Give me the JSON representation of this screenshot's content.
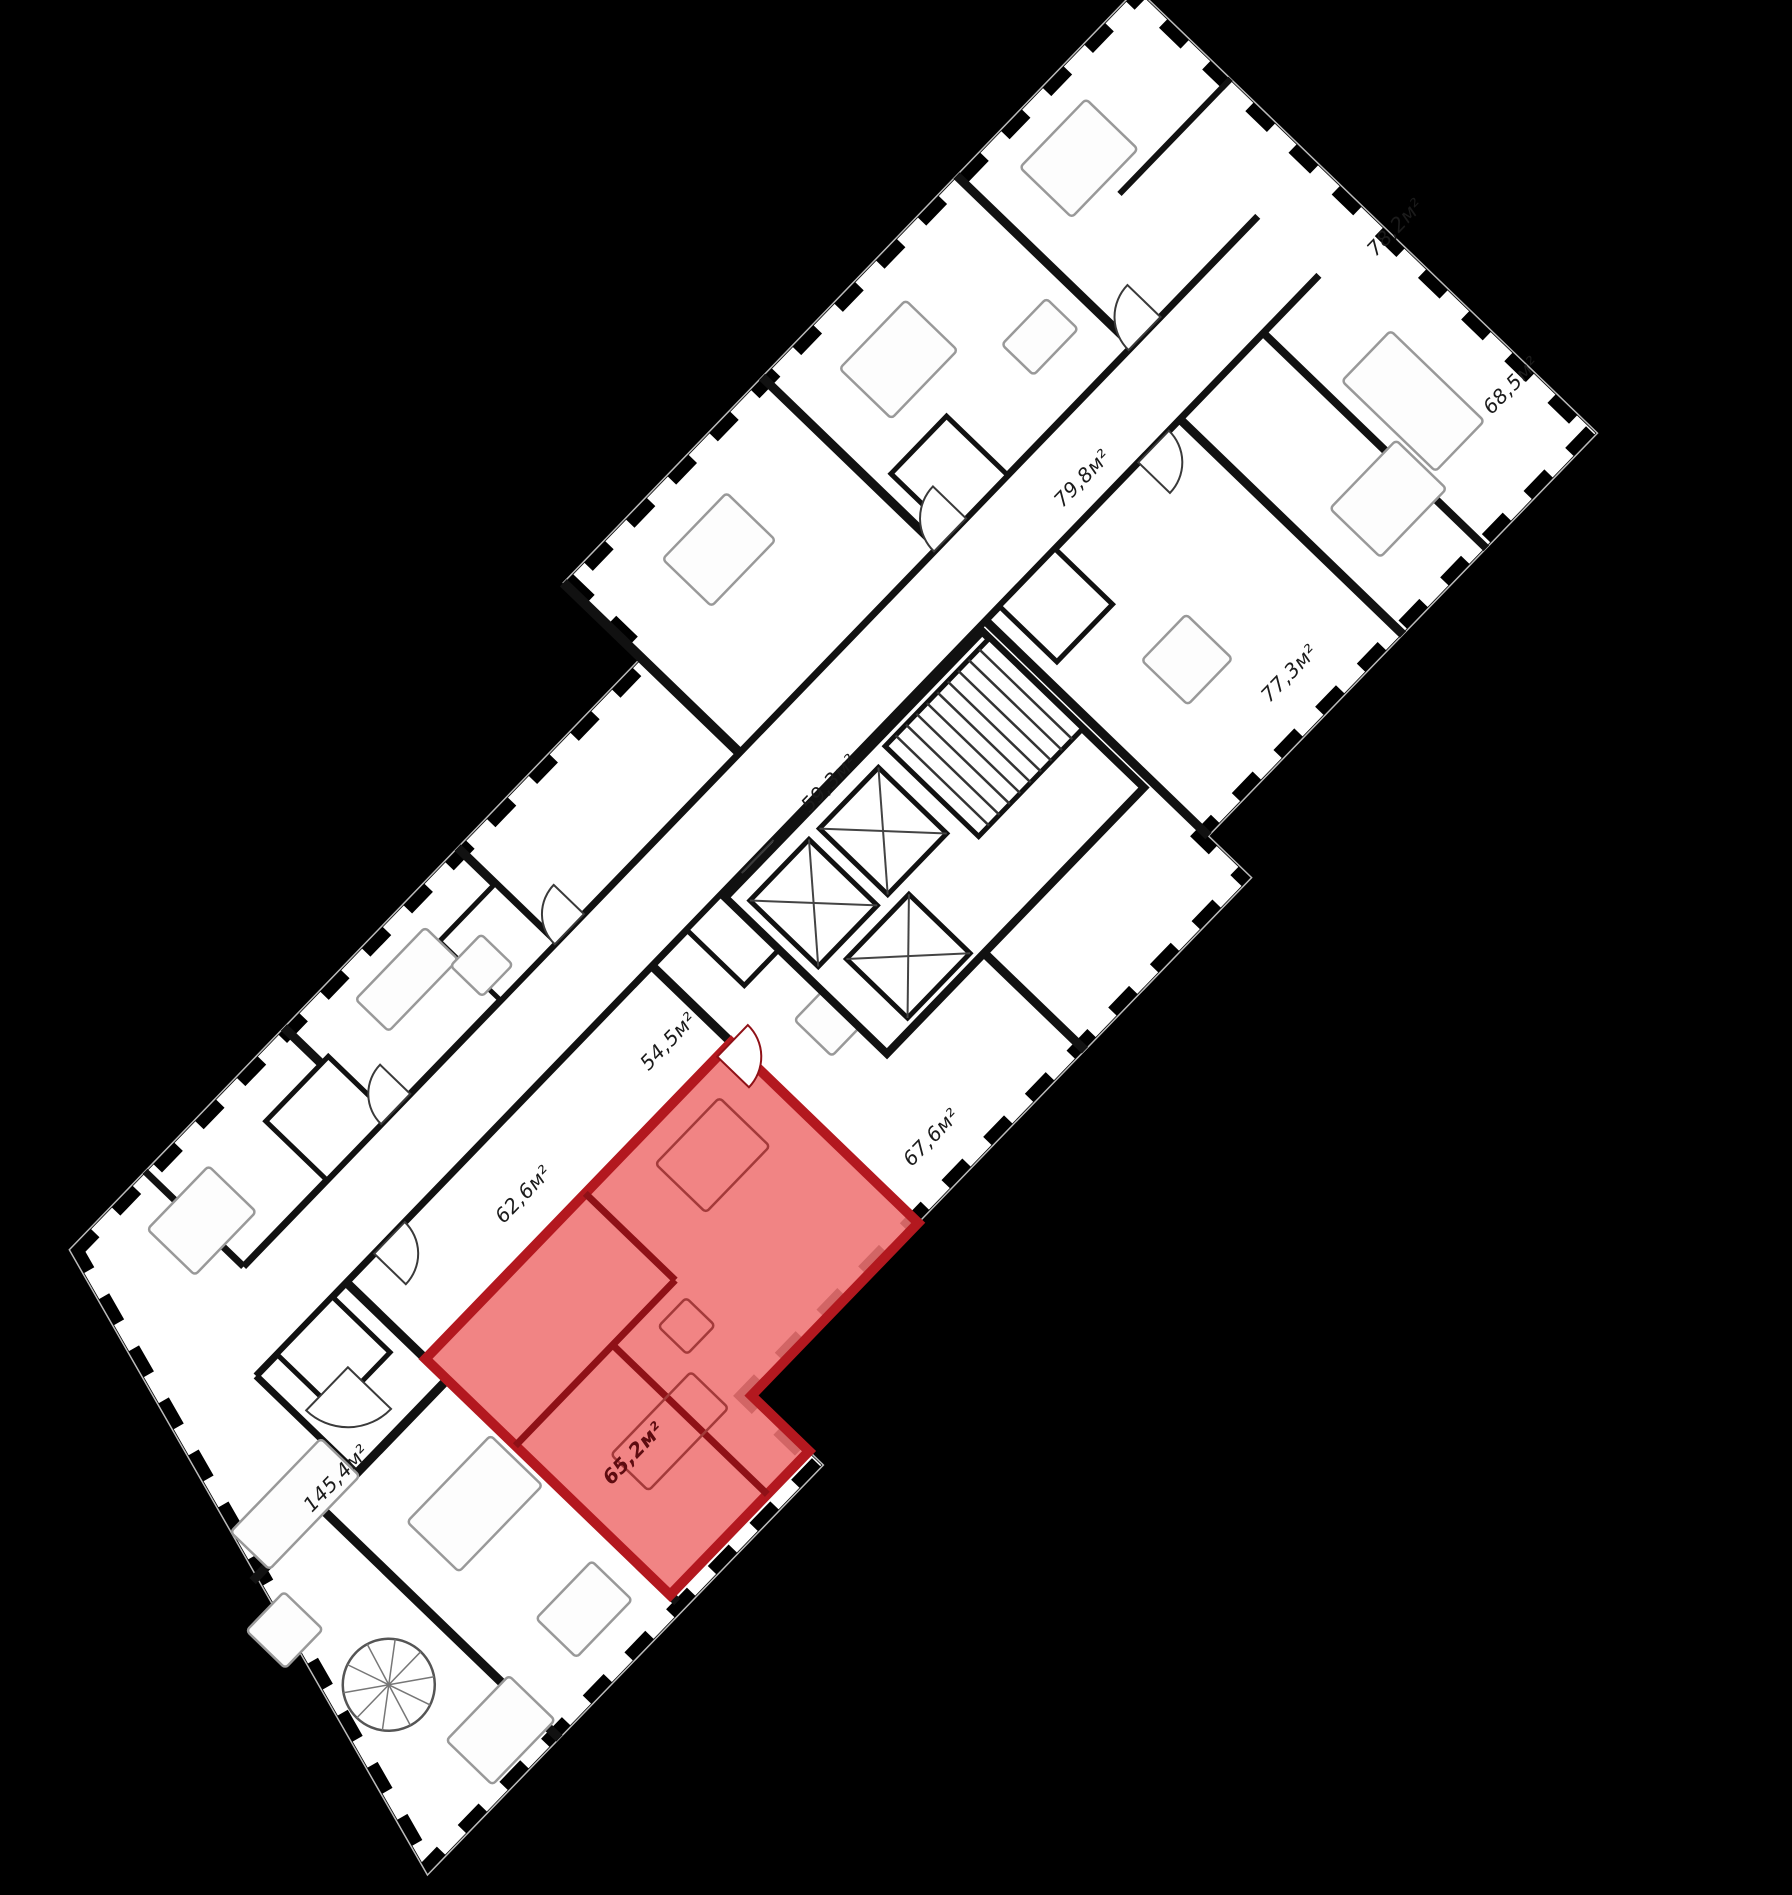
{
  "floorplan": {
    "background_color": "#000000",
    "plate_color": "#ffffff",
    "wall_color": "#111111",
    "highlight_fill": "#ef7373",
    "highlight_border": "#b3181f",
    "units_suffix": "м²",
    "apartments": [
      {
        "area_label": "78,2м²",
        "highlighted": false
      },
      {
        "area_label": "68,5м²",
        "highlighted": false
      },
      {
        "area_label": "79,8м²",
        "highlighted": false
      },
      {
        "area_label": "77,3м²",
        "highlighted": false
      },
      {
        "area_label": "59,3м²",
        "highlighted": false
      },
      {
        "area_label": "54,5м²",
        "highlighted": false
      },
      {
        "area_label": "67,6м²",
        "highlighted": false
      },
      {
        "area_label": "62,6м²",
        "highlighted": false
      },
      {
        "area_label": "65,2м²",
        "highlighted": true
      },
      {
        "area_label": "145,4м²",
        "highlighted": false
      }
    ],
    "highlighted_apartment": {
      "area_label": "65,2м²"
    }
  }
}
